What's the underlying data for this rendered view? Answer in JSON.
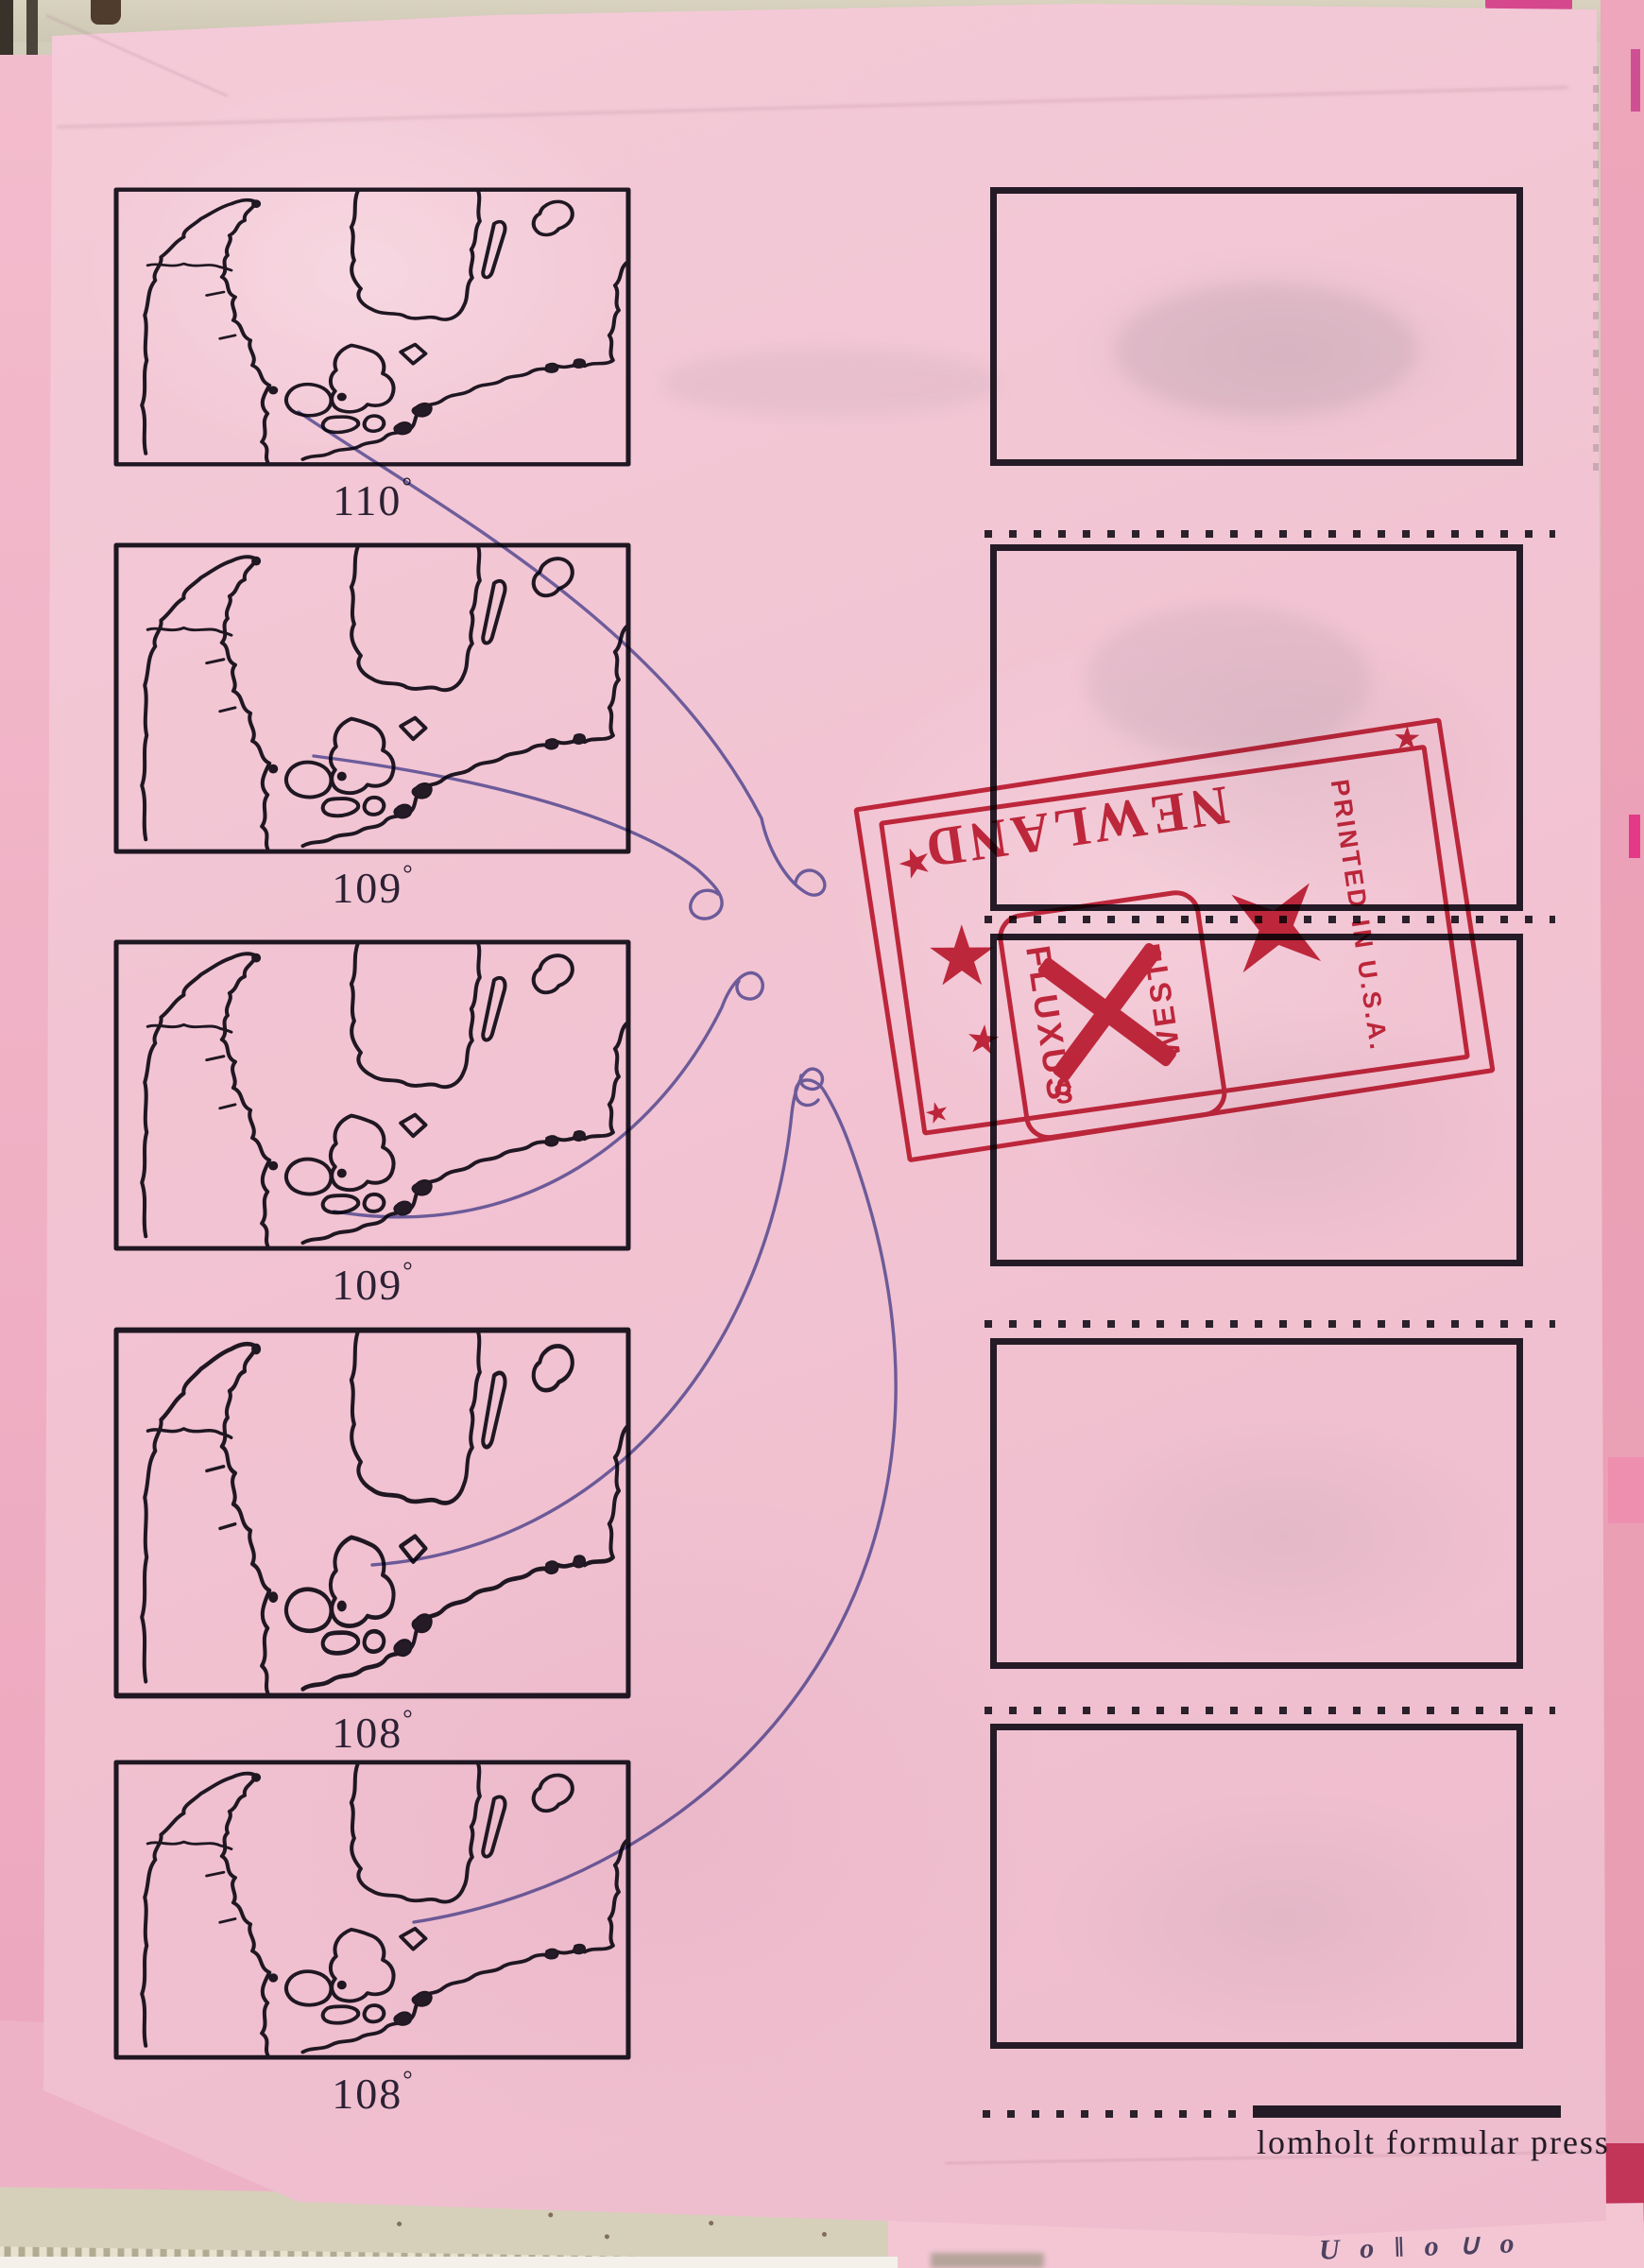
{
  "document": {
    "map_labels": [
      {
        "value": "110"
      },
      {
        "value": "109"
      },
      {
        "value": "109"
      },
      {
        "value": "108"
      },
      {
        "value": "108"
      }
    ],
    "degree_symbol": "°",
    "stamp": {
      "newland": "NEWLAND",
      "ticket_left": "FLUXUS",
      "ticket_right": "WEST",
      "ticket_letter_s": "S",
      "ticket_letter_e": "E",
      "printed": "PRINTED IN U.S.A."
    },
    "imprint": "lomholt formular press",
    "doodle": "U o ‖ o ∪ o"
  },
  "icons": {
    "star": "★"
  },
  "colors": {
    "paper_pink": "#f2c3d2",
    "under_sheet_pink": "#eda6bb",
    "stamp_red": "#c32138",
    "ink_blue": "#5a5fae",
    "print_black": "#241b26",
    "backing_beige": "#d6cfba"
  }
}
